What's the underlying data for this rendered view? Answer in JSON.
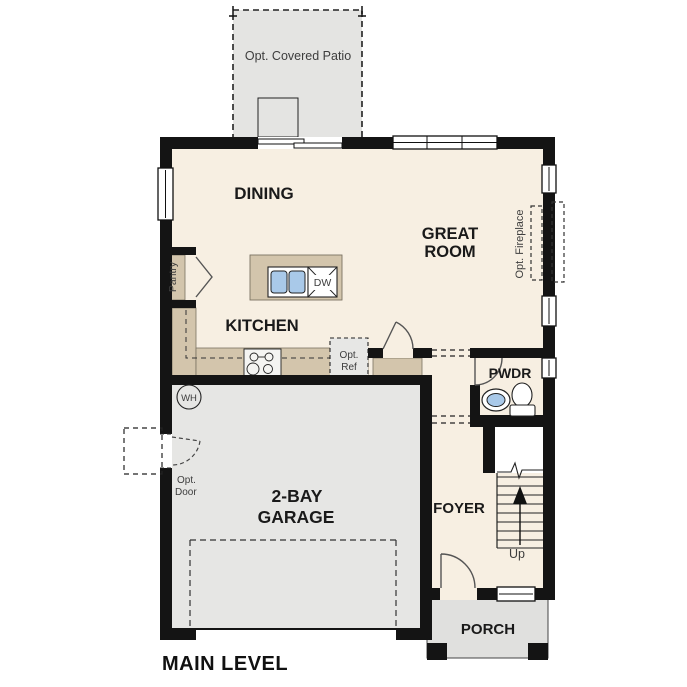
{
  "title": "MAIN LEVEL",
  "rooms": {
    "dining": "DINING",
    "great_room_line1": "GREAT",
    "great_room_line2": "ROOM",
    "kitchen": "KITCHEN",
    "garage_line1": "2-BAY",
    "garage_line2": "GARAGE",
    "foyer": "FOYER",
    "powder": "PWDR",
    "porch": "PORCH"
  },
  "annotations": {
    "patio": "Opt. Covered Patio",
    "fireplace": "Opt. Fireplace",
    "pantry": "Pantry",
    "ref_line1": "Opt.",
    "ref_line2": "Ref",
    "opt_door_line1": "Opt.",
    "opt_door_line2": "Door",
    "water_heater": "WH",
    "dishwasher": "DW",
    "stairs_up": "Up"
  },
  "colors": {
    "wall": "#141414",
    "floor": "#f7efe2",
    "garage_floor": "#e6e6e4",
    "patio": "#e4e4e2",
    "porch": "#e0e0de",
    "counter": "#d3c5ac",
    "sink_blue": "#a9c9e9",
    "annotation_text": "#3d3d3d"
  }
}
